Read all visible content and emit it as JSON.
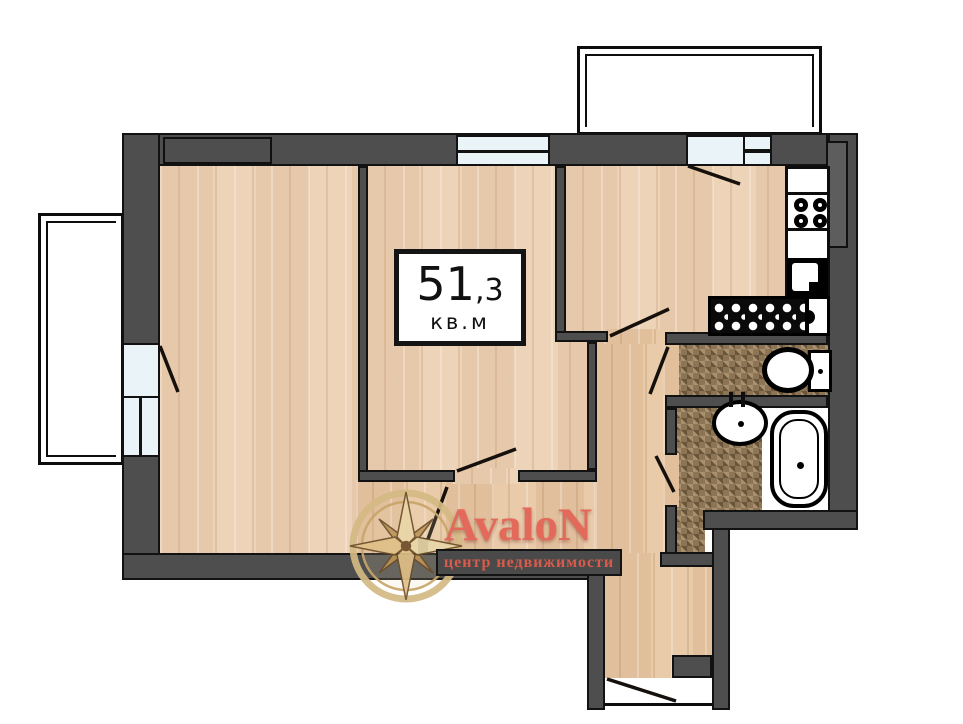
{
  "area_label": {
    "value": "51",
    "fraction": ",3",
    "unit": "кв.м"
  },
  "logo": {
    "brand": "AvaloN",
    "tagline": "центр недвижимости"
  },
  "colors": {
    "wall": "#4e4e4e",
    "wall_outline": "#121212",
    "wood_floor": "#ecd2b6",
    "hall_floor": "#e7c8a6",
    "bath_tile": "#8d7454",
    "window_glass": "#e9f3f8",
    "balcony_fill": "#ffffff",
    "brand_red": "#e3695a",
    "logo_gold": "#d4ba84"
  },
  "legend": {
    "fixtures": [
      "stove",
      "kitchen-sink",
      "ventilation-hatch",
      "toilet",
      "washbasin",
      "bathtub"
    ],
    "balconies": 2,
    "windows": 5,
    "door_swings": 8
  }
}
